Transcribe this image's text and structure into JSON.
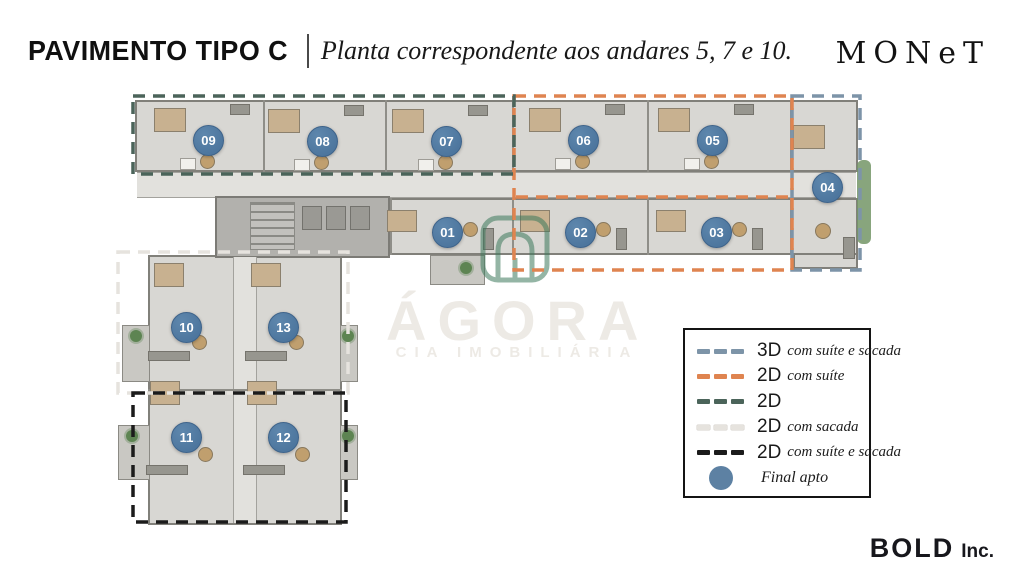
{
  "header": {
    "title": "PAVIMENTO TIPO C",
    "subtitle": "Planta correspondente aos andares 5, 7 e 10.",
    "brand": "MONeT"
  },
  "watermark": {
    "name": "ÁGORA",
    "subtitle": "CIA IMOBILIÁRIA",
    "icon_color": "#3d7a5c"
  },
  "legend": {
    "items": [
      {
        "label": "3D",
        "desc": "com suíte e sacada",
        "swatch": "dash",
        "color": "#7d94a8"
      },
      {
        "label": "2D",
        "desc": "com suíte",
        "swatch": "dash",
        "color": "#df8450"
      },
      {
        "label": "2D",
        "desc": "",
        "swatch": "dash",
        "color": "#4b645a"
      },
      {
        "label": "2D",
        "desc": "com sacada",
        "swatch": "dash",
        "color": "#e6e3de"
      },
      {
        "label": "2D",
        "desc": "com suíte e sacada",
        "swatch": "dash",
        "color": "#1b1b1b"
      },
      {
        "label": "",
        "desc": "Final apto",
        "swatch": "circle",
        "color": "#5d81a3"
      }
    ]
  },
  "plan": {
    "badge_color": "#4d769e",
    "units": [
      {
        "id": "01",
        "x": 447,
        "y": 232
      },
      {
        "id": "02",
        "x": 580,
        "y": 232
      },
      {
        "id": "03",
        "x": 716,
        "y": 232
      },
      {
        "id": "04",
        "x": 827,
        "y": 187
      },
      {
        "id": "05",
        "x": 712,
        "y": 140
      },
      {
        "id": "06",
        "x": 583,
        "y": 140
      },
      {
        "id": "07",
        "x": 446,
        "y": 141
      },
      {
        "id": "08",
        "x": 322,
        "y": 141
      },
      {
        "id": "09",
        "x": 208,
        "y": 140
      },
      {
        "id": "10",
        "x": 186,
        "y": 327
      },
      {
        "id": "11",
        "x": 186,
        "y": 437
      },
      {
        "id": "12",
        "x": 283,
        "y": 437
      },
      {
        "id": "13",
        "x": 283,
        "y": 327
      }
    ],
    "outlines": [
      {
        "name": "3d-com-suite-e-sacada",
        "color": "#7d94a8",
        "x": 792,
        "y": 96,
        "w": 68,
        "h": 174
      },
      {
        "name": "2d-com-suite",
        "color": "#df8450",
        "x": 514,
        "y": 96,
        "w": 278,
        "h": 174
      },
      {
        "name": "2d",
        "color": "#4b645a",
        "x": 133,
        "y": 96,
        "w": 381,
        "h": 78
      },
      {
        "name": "2d-com-sacada",
        "color": "#e6e3de",
        "x": 118,
        "y": 252,
        "w": 230,
        "h": 141
      },
      {
        "name": "2d-com-suite-e-sacada",
        "color": "#1b1b1b",
        "x": 133,
        "y": 393,
        "w": 213,
        "h": 129
      }
    ],
    "lines": [
      {
        "color": "#df8450",
        "x1": 516,
        "y1": 197,
        "x2": 790,
        "y2": 197
      }
    ]
  },
  "footer": {
    "brand": "BOLD",
    "suffix": "Inc."
  }
}
